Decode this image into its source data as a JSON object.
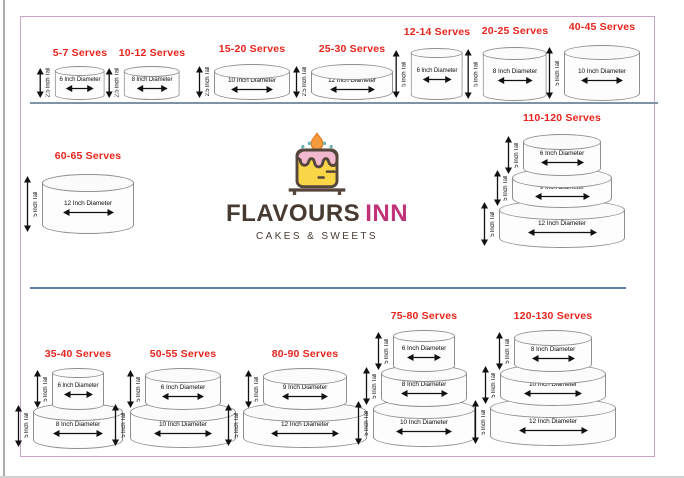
{
  "brand": {
    "name_primary": "FLAVOURS",
    "name_secondary": "INN",
    "tagline": "CAKES & SWEETS"
  },
  "cakes": [
    {
      "serves": "5-7 Serves",
      "tiers": [
        {
          "height": "2.5 Inch Tall",
          "diameter": "6 Inch Diameter"
        }
      ]
    },
    {
      "serves": "10-12 Serves",
      "tiers": [
        {
          "height": "2.5 Inch Tall",
          "diameter": "8 Inch Diameter"
        }
      ]
    },
    {
      "serves": "15-20 Serves",
      "tiers": [
        {
          "height": "2.5 Inch Tall",
          "diameter": "10 Inch Diameter"
        }
      ]
    },
    {
      "serves": "25-30 Serves",
      "tiers": [
        {
          "height": "2.5 Inch Tall",
          "diameter": "12 Inch Diameter"
        }
      ]
    },
    {
      "serves": "12-14 Serves",
      "tiers": [
        {
          "height": "5 Inch Tall",
          "diameter": "6 Inch Diameter"
        }
      ]
    },
    {
      "serves": "20-25 Serves",
      "tiers": [
        {
          "height": "5 Inch Tall",
          "diameter": "8 Inch Diameter"
        }
      ]
    },
    {
      "serves": "40-45 Serves",
      "tiers": [
        {
          "height": "5 Inch Tall",
          "diameter": "10 Inch Diameter"
        }
      ]
    },
    {
      "serves": "60-65 Serves",
      "tiers": [
        {
          "height": "5 Inch Tall",
          "diameter": "12 Inch Diameter"
        }
      ]
    },
    {
      "serves": "110-120 Serves",
      "tiers": [
        {
          "height": "5 Inch Tall",
          "diameter": "6 Inch Diameter"
        },
        {
          "height": "5 Inch Tall",
          "diameter": "9 Inch Diameter"
        },
        {
          "height": "5 Inch Tall",
          "diameter": "12 Inch Diameter"
        }
      ]
    },
    {
      "serves": "35-40 Serves",
      "tiers": [
        {
          "height": "5 Inch Tall",
          "diameter": "6 Inch Diameter"
        },
        {
          "height": "5 Inch Tall",
          "diameter": "8 Inch Diameter"
        }
      ]
    },
    {
      "serves": "50-55 Serves",
      "tiers": [
        {
          "height": "5 Inch Tall",
          "diameter": "6 Inch Diameter"
        },
        {
          "height": "5 Inch Tall",
          "diameter": "10 Inch Diameter"
        }
      ]
    },
    {
      "serves": "80-90 Serves",
      "tiers": [
        {
          "height": "5 Inch Tall",
          "diameter": "9 Inch Diameter"
        },
        {
          "height": "5 Inch Tall",
          "diameter": "12 Inch Diameter"
        }
      ]
    },
    {
      "serves": "75-80 Serves",
      "tiers": [
        {
          "height": "5 Inch Tall",
          "diameter": "6 Inch Diameter"
        },
        {
          "height": "5 Inch Tall",
          "diameter": "8 Inch Diameter"
        },
        {
          "height": "5 Inch Tall",
          "diameter": "10 Inch Diameter"
        }
      ]
    },
    {
      "serves": "120-130 Serves",
      "tiers": [
        {
          "height": "5 Inch Tall",
          "diameter": "8 Inch Diameter"
        },
        {
          "height": "5 Inch Tall",
          "diameter": "10 Inch Diameter"
        },
        {
          "height": "5 Inch Tall",
          "diameter": "12 Inch Diameter"
        }
      ]
    }
  ],
  "colors": {
    "serves_text": "#e8241c",
    "frame_border": "#c9a3c9",
    "divider_top": "#7e94a6",
    "divider_middle": "#5f80ae",
    "cake_outline": "#8f8f8f",
    "brand_primary": "#473a31",
    "brand_secondary": "#c03379",
    "logo_yellow": "#f8d648",
    "logo_pink": "#f2b8cd",
    "logo_flame": "#f59b3d",
    "logo_teal": "#68b2b4",
    "logo_outline": "#55453b"
  }
}
